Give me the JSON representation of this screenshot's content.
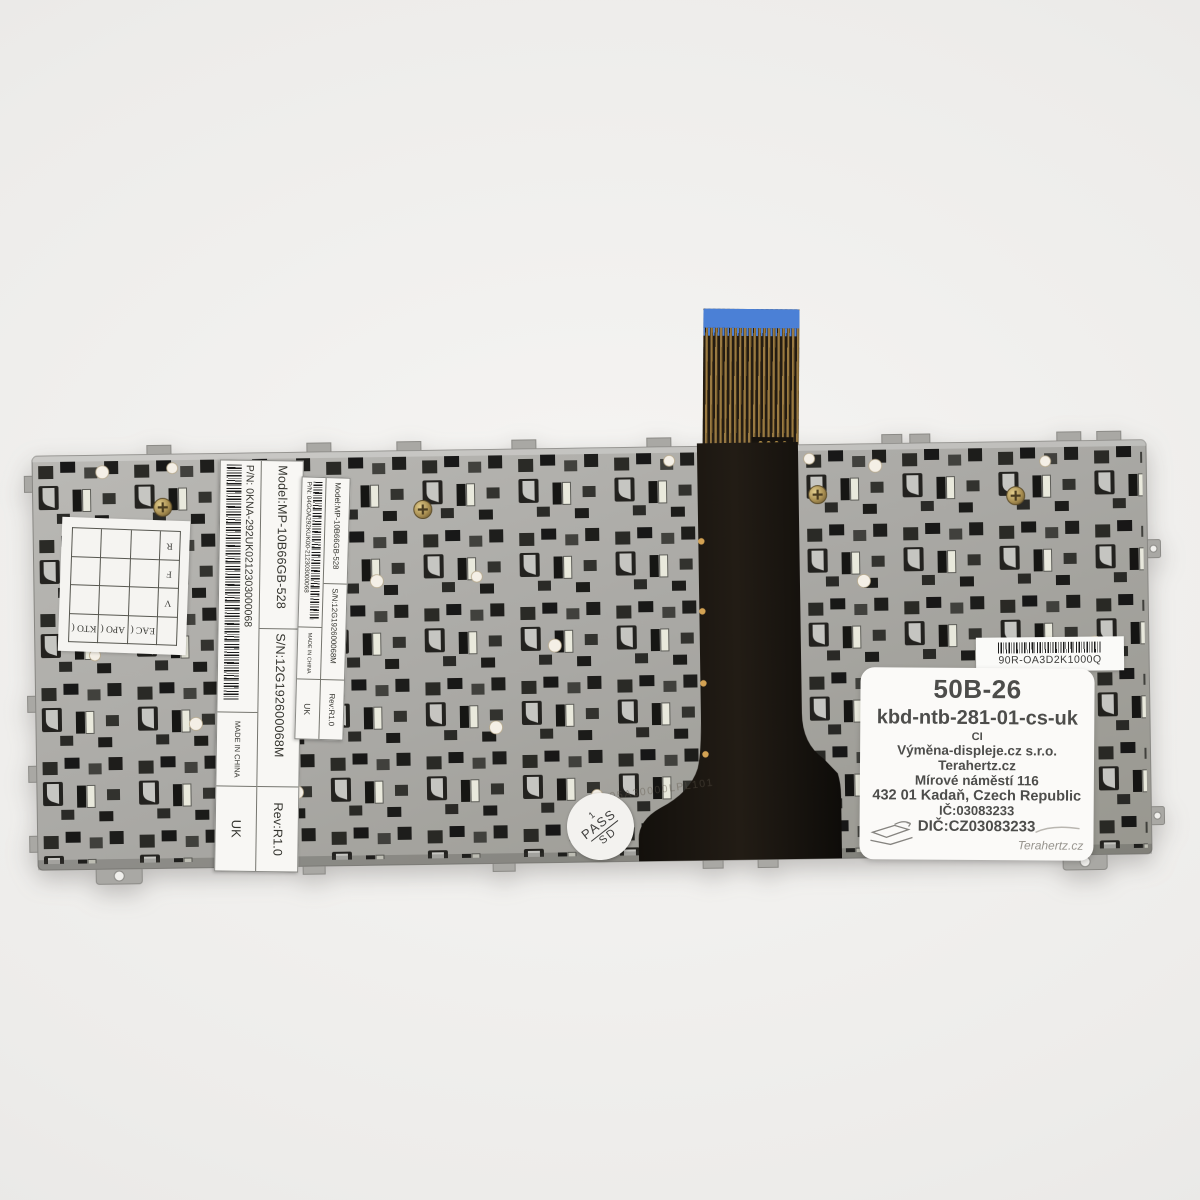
{
  "subject": "Rear metal backplate of a laptop keyboard with flex ribbon cable and product labels",
  "colors": {
    "background": "#eeedeb",
    "plate_metal": "#a9a8a4",
    "membrane_black": "#17120d",
    "ribbon_blue": "#4b80d6",
    "ribbon_trace_gold": "#9a7a42",
    "label_white": "#f8f7f4",
    "screw_brass": "#a98f52"
  },
  "labels": {
    "manufacturer_label_large": {
      "model": "Model:MP-10B66GB-528",
      "serial": "S/N:12G192600068M",
      "rev": "Rev:R1.0",
      "part": "P/N:  0KNA-292UK0212303000068",
      "made_in": "MADE IN CHINA",
      "country": "UK"
    },
    "manufacturer_label_small": {
      "model": "Model:MP-10B66GB-528",
      "serial": "S/N:12G192600068M",
      "rev": "Rev:R1.0",
      "part": "P/N:  04GOA292KUK00-212303000068",
      "made_in": "MADE IN CHINA",
      "country": "UK"
    },
    "barcode_label": {
      "code": "90R-OA3D2K1000Q"
    },
    "seller_label": {
      "lines": [
        "50B-26",
        "kbd-ntb-281-01-cs-uk",
        "CI",
        "Výměna-displeje.cz s.r.o.",
        "Terahertz.cz",
        "Mírové náměstí 116",
        "432 01 Kadaň, Czech Republic",
        "IČ:03083233",
        "DIČ:CZ03083233"
      ],
      "signature": "Terahertz.cz"
    },
    "qc_grid_label": {
      "right_column": [
        "R",
        "F",
        "V"
      ],
      "bottom_row": [
        "KTO (",
        "APO (",
        "EAC ("
      ]
    },
    "pass_sticker": {
      "top": "1",
      "middle": "PASS",
      "bottom": "SD"
    },
    "etched_code": "05A30000LPL101"
  }
}
